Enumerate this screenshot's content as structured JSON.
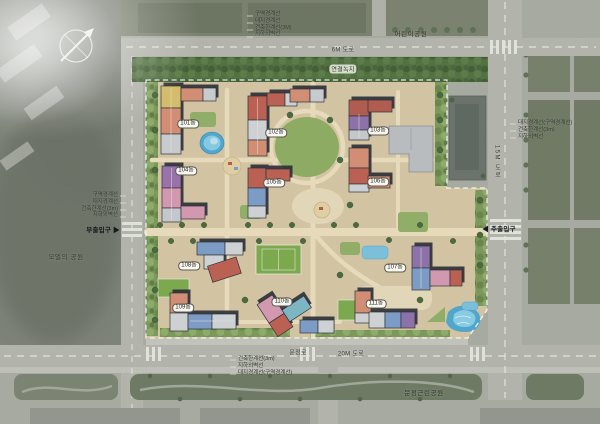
{
  "buildings": [
    {
      "label": "101동"
    },
    {
      "label": "102동"
    },
    {
      "label": "103동"
    },
    {
      "label": "104동"
    },
    {
      "label": "105동"
    },
    {
      "label": "106동"
    },
    {
      "label": "107동"
    },
    {
      "label": "108동"
    },
    {
      "label": "109동"
    },
    {
      "label": "110동"
    },
    {
      "label": "111동"
    }
  ],
  "roads": {
    "top": "6M 도로",
    "right": "15M 도로",
    "bottom": "20M 도로",
    "street": "문정로"
  },
  "parks": {
    "children_park": "어린이공원",
    "neighborhood_park": "문정근린공원",
    "west_park": "모델의 공원"
  },
  "green_belt": {
    "label": "연결녹지"
  },
  "entrances": {
    "secondary": {
      "label": "부출입구",
      "arrow": "▶"
    },
    "main": {
      "label": "주출입구",
      "arrow": "◀"
    }
  },
  "annotations": {
    "top": [
      "구역경계선",
      "대지경계선",
      "건축한계선(3M)",
      "지하외벽선"
    ],
    "left": [
      "구역경계선",
      "대지경계선",
      "건축한계선(3m)",
      "지하외벽선"
    ],
    "right": [
      "대지경계선(구역경계선)",
      "건축한계선(3m)",
      "지하외벽선"
    ],
    "bottom": [
      "건축한계선(3m)",
      "지하외벽선",
      "대지경계선(구역경계선)"
    ]
  },
  "colors": {
    "site_base": "#d8c9a6",
    "water": "#4fa9d2",
    "lawn": "#7cab4c",
    "green_belt": "#51713f",
    "road": "#b6b8b0",
    "forest": "#82877e",
    "building_outline": "#262a33",
    "boundary_dash": "#ffffff"
  }
}
